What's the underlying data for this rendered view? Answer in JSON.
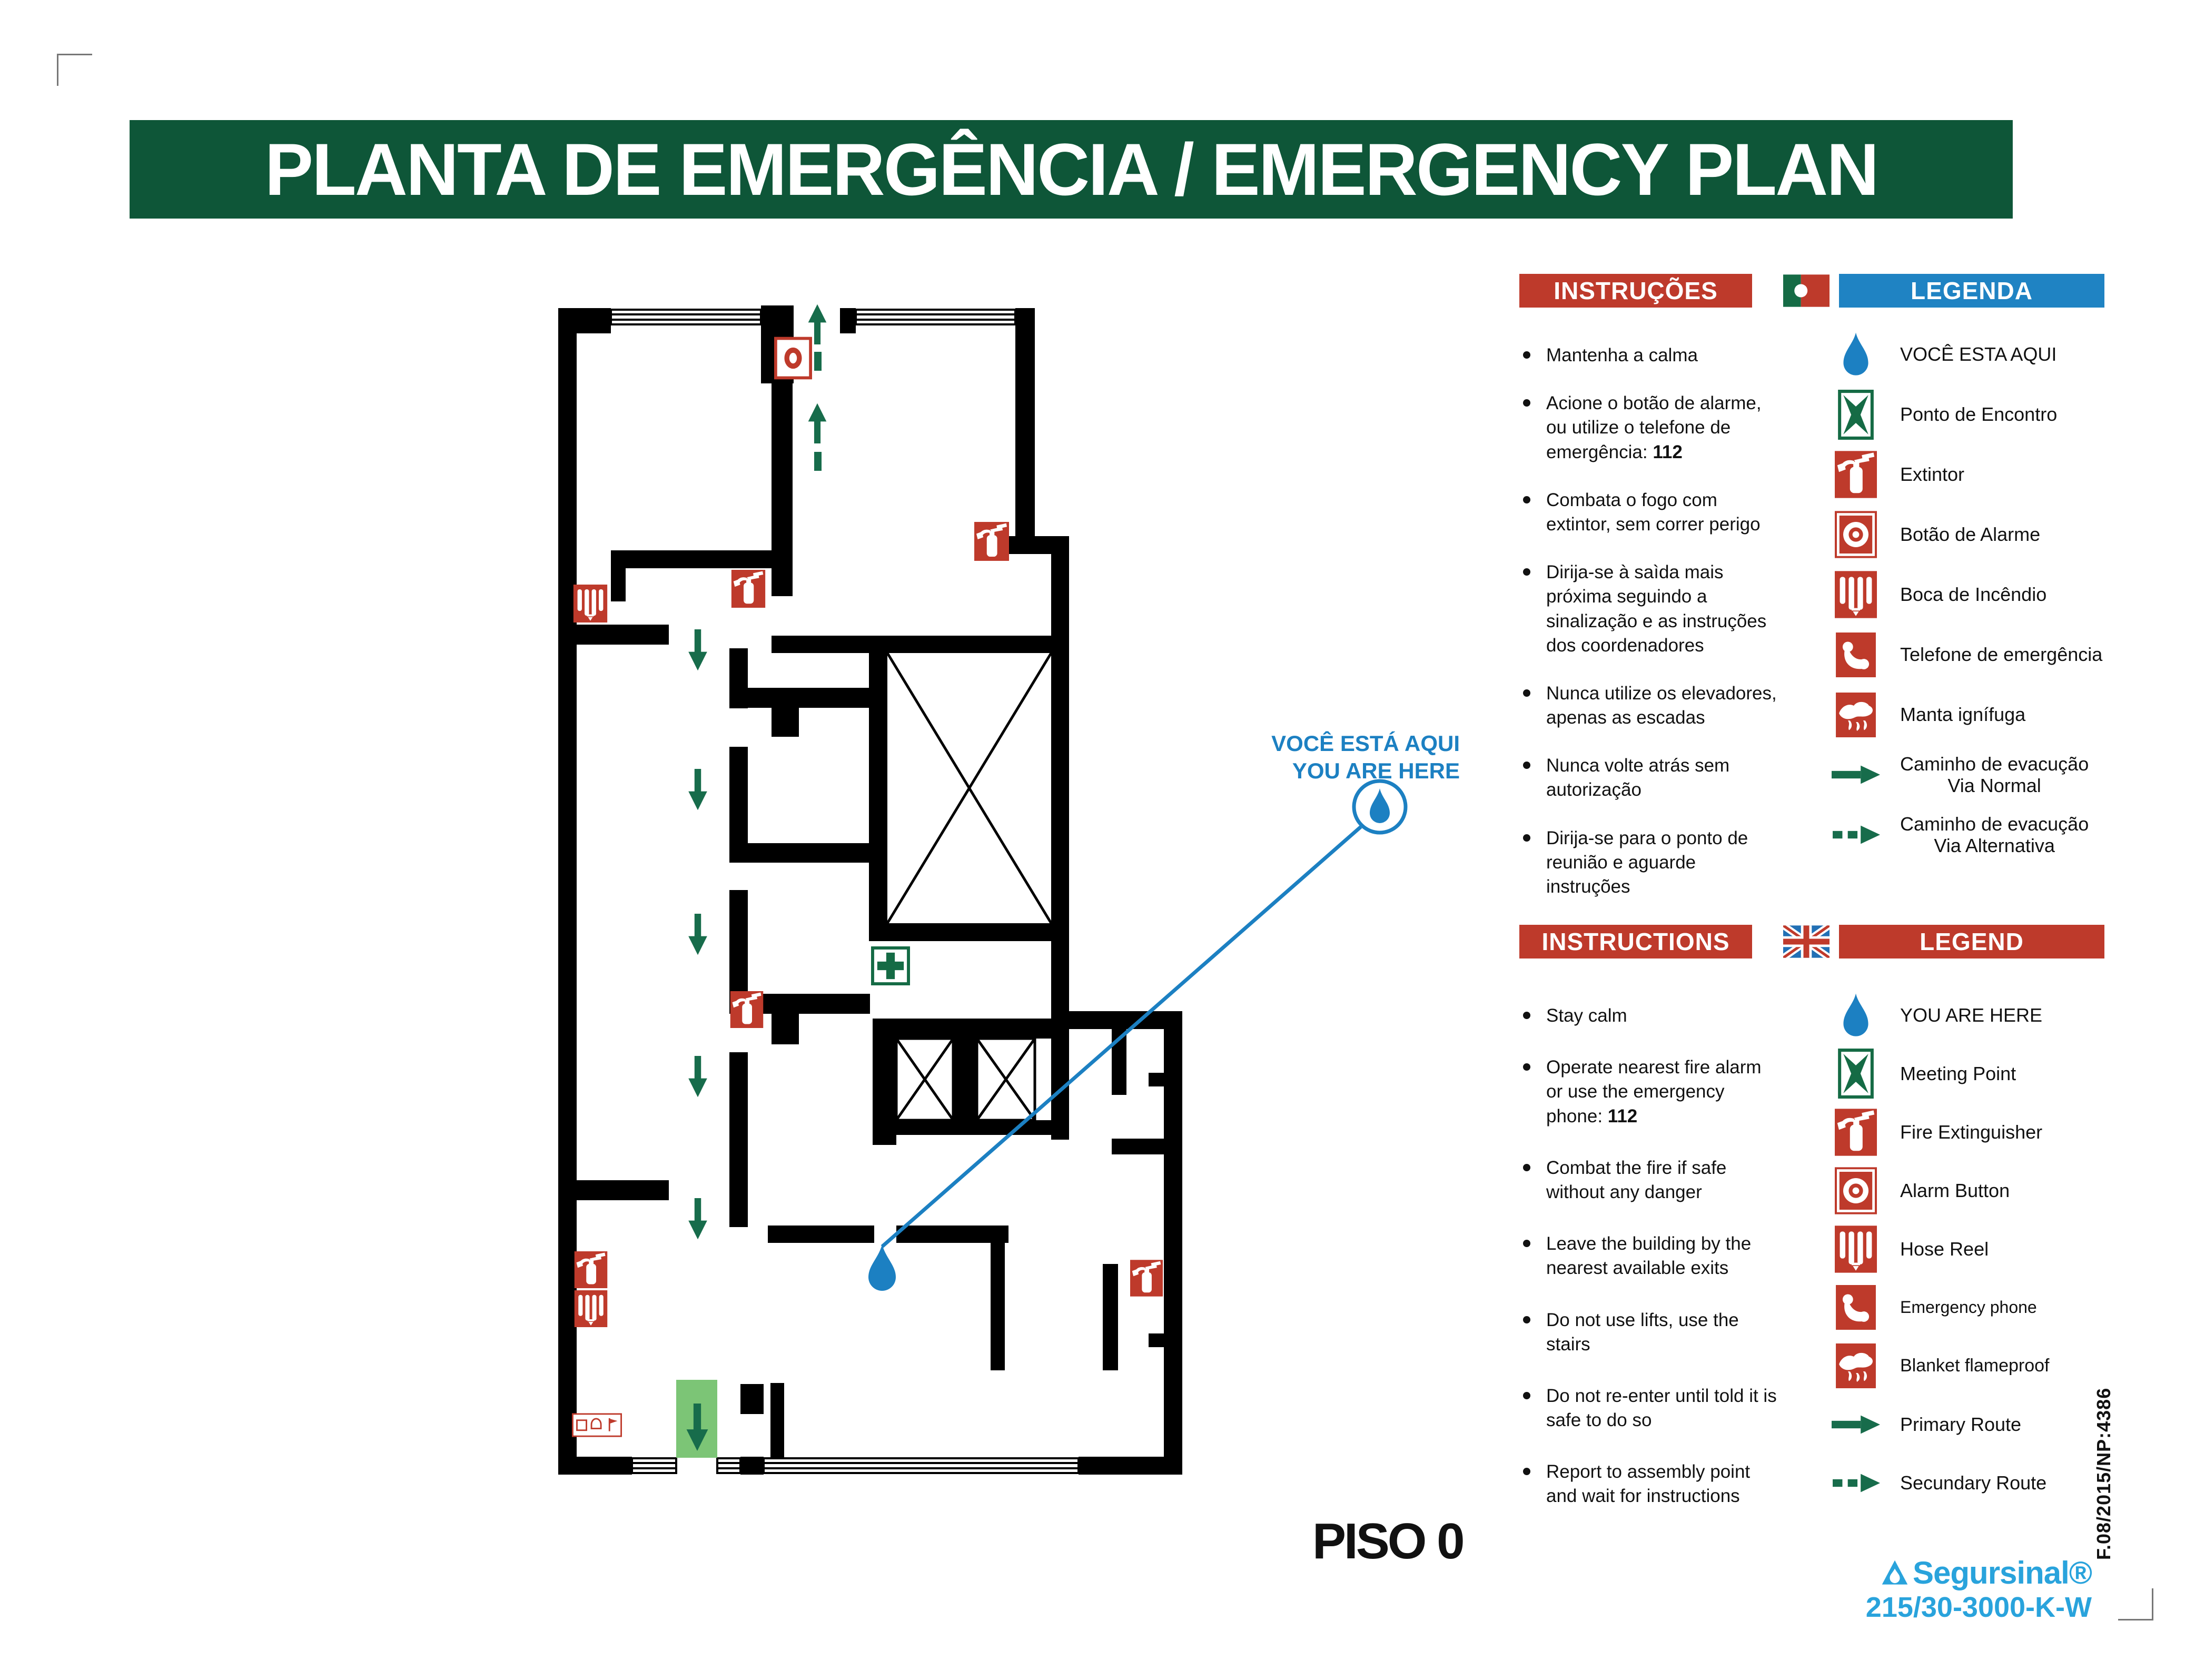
{
  "title": "PLANTA DE EMERGÊNCIA / EMERGENCY PLAN",
  "floor_label": "PISO 0",
  "plan": {
    "callout_line1": "VOCÊ ESTÁ AQUI",
    "callout_line2": "YOU ARE HERE",
    "colors": {
      "wall": "#000000",
      "route_green": "#176C4B",
      "exit_green": "#7CC576",
      "marker_blue": "#1C80C2",
      "icon_red": "#BE3A2B",
      "first_aid_green": "#156B45"
    }
  },
  "sections": {
    "pt": {
      "instructions_title": "INSTRUÇÕES",
      "legend_title": "LEGENDA",
      "instructions": [
        {
          "text": "Mantenha a calma",
          "strong": ""
        },
        {
          "text": "Acione o botão de alarme, ou utilize o telefone de emergência: ",
          "strong": "112"
        },
        {
          "text": "Combata o fogo com extintor, sem correr perigo",
          "strong": ""
        },
        {
          "text": "Dirija-se à saìda mais próxima seguindo a sinalização e as instruções dos coordenadores",
          "strong": ""
        },
        {
          "text": "Nunca utilize os elevadores, apenas as escadas",
          "strong": ""
        },
        {
          "text": "Nunca volte atrás sem autorização",
          "strong": ""
        },
        {
          "text": "Dirija-se para o ponto de reunião e aguarde instruções",
          "strong": ""
        }
      ],
      "legend": [
        {
          "icon": "you-are-here-drop-icon",
          "line1": "VOCÊ ESTA AQUI",
          "line2": ""
        },
        {
          "icon": "meeting-point-icon",
          "line1": "Ponto de Encontro",
          "line2": ""
        },
        {
          "icon": "fire-extinguisher-icon",
          "line1": "Extintor",
          "line2": ""
        },
        {
          "icon": "alarm-button-icon",
          "line1": "Botão de Alarme",
          "line2": ""
        },
        {
          "icon": "hose-reel-icon",
          "line1": "Boca de Incêndio",
          "line2": ""
        },
        {
          "icon": "emergency-phone-icon",
          "line1": "Telefone de emergência",
          "line2": ""
        },
        {
          "icon": "fire-blanket-icon",
          "line1": "Manta ignífuga",
          "line2": ""
        },
        {
          "icon": "primary-route-arrow-icon",
          "line1": "Caminho de evacução",
          "line2": "Via Normal"
        },
        {
          "icon": "secondary-route-arrow-icon",
          "line1": "Caminho de evacução",
          "line2": "Via Alternativa"
        }
      ]
    },
    "en": {
      "instructions_title": "INSTRUCTIONS",
      "legend_title": "LEGEND",
      "instructions": [
        {
          "text": "Stay calm",
          "strong": ""
        },
        {
          "text": "Operate nearest fire alarm or use the emergency phone: ",
          "strong": "112"
        },
        {
          "text": "Combat the fire if safe without any danger",
          "strong": ""
        },
        {
          "text": "Leave the building by the nearest available exits",
          "strong": ""
        },
        {
          "text": "Do not use lifts, use the stairs",
          "strong": ""
        },
        {
          "text": "Do not re-enter until told it is safe to do so",
          "strong": ""
        },
        {
          "text": "Report to assembly point and wait for instructions",
          "strong": ""
        }
      ],
      "legend": [
        {
          "icon": "you-are-here-drop-icon",
          "line1": "YOU ARE HERE",
          "line2": ""
        },
        {
          "icon": "meeting-point-icon",
          "line1": "Meeting Point",
          "line2": ""
        },
        {
          "icon": "fire-extinguisher-icon",
          "line1": "Fire Extinguisher",
          "line2": ""
        },
        {
          "icon": "alarm-button-icon",
          "line1": "Alarm Button",
          "line2": ""
        },
        {
          "icon": "hose-reel-icon",
          "line1": "Hose Reel",
          "line2": ""
        },
        {
          "icon": "emergency-phone-icon",
          "line1": "Emergency phone",
          "line2": ""
        },
        {
          "icon": "fire-blanket-icon",
          "line1": "Blanket flameproof",
          "line2": ""
        },
        {
          "icon": "primary-route-arrow-icon",
          "line1": "Primary Route",
          "line2": ""
        },
        {
          "icon": "secondary-route-arrow-icon",
          "line1": "Secundary Route",
          "line2": ""
        }
      ]
    }
  },
  "footer": {
    "brand": "Segursinal®",
    "model": "215/30-3000-K-W",
    "ref": "F.08/2015/NP:4386"
  }
}
